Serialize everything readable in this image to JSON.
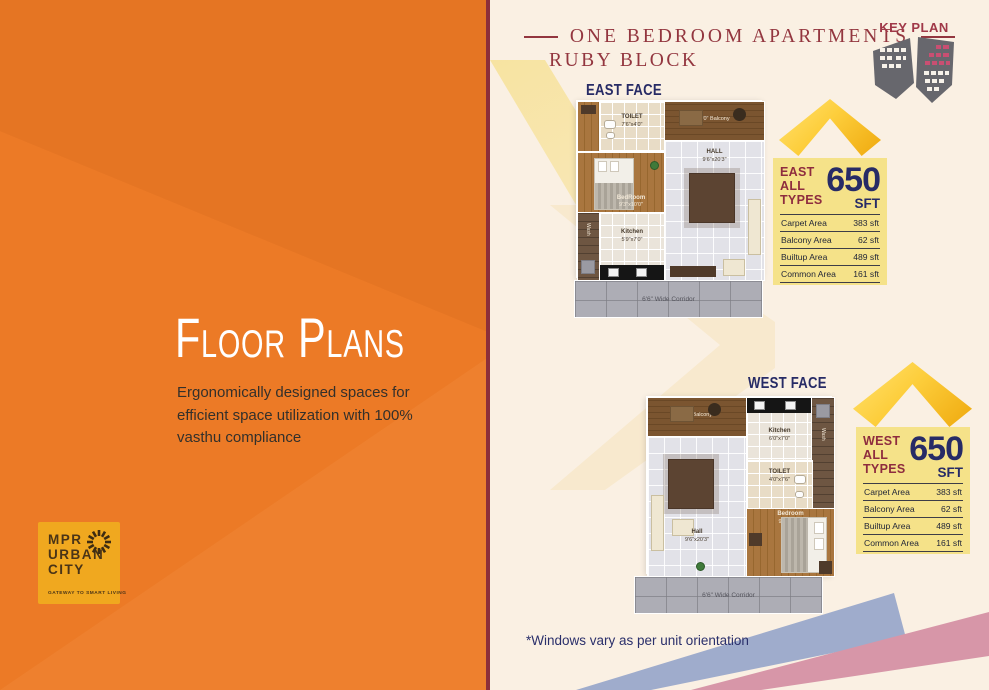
{
  "left_panel": {
    "title": "Floor Plans",
    "description": "Ergonomically designed spaces for efficient space utilization with 100% vasthu compliance",
    "logo": {
      "name_line1": "MPR",
      "name_line2": "URBAN",
      "name_line3": "CITY",
      "tagline": "GATEWAY TO SMART LIVING",
      "icon": "sunburst-icon"
    }
  },
  "right_panel": {
    "heading": {
      "title": "ONE BEDROOM APARTMENTS",
      "subtitle": "RUBY BLOCK"
    },
    "key_plan_label": "KEY PLAN",
    "east": {
      "face_label": "EAST FACE",
      "plan": {
        "balcony": "4'0\" Balcony",
        "toilet_name": "TOILET",
        "toilet_dim": "7'6\"x4'0\"",
        "bedroom_name": "BedRoom",
        "bedroom_dim": "9'3\"x10'0\"",
        "hall_name": "HALL",
        "hall_dim": "9'6\"x20'3\"",
        "kitchen_name": "Kitchen",
        "kitchen_dim": "5'9\"x7'0\"",
        "wash": "Wash",
        "corridor": "6'6\" Wide Corridor"
      },
      "table": {
        "block": "EAST",
        "line2": "ALL",
        "line3": "TYPES",
        "area_value": "650",
        "area_unit": "SFT",
        "rows": [
          {
            "label": "Carpet Area",
            "value": "383 sft"
          },
          {
            "label": "Balcony Area",
            "value": "62 sft"
          },
          {
            "label": "Builtup Area",
            "value": "489 sft"
          },
          {
            "label": "Common Area",
            "value": "161 sft"
          }
        ]
      }
    },
    "west": {
      "face_label": "WEST FACE",
      "plan": {
        "balcony": "4'0\" Balcony",
        "toilet_name": "TOILET",
        "toilet_dim": "4'0\"x7'6\"",
        "bedroom_name": "Bedroom",
        "bedroom_dim": "9'3\"x10'0\"",
        "hall_name": "Hall",
        "hall_dim": "9'6\"x20'3\"",
        "kitchen_name": "Kitchen",
        "kitchen_dim": "6'0\"x7'0\"",
        "wash": "Wash",
        "corridor": "6'6\" Wide Corridor"
      },
      "table": {
        "block": "WEST",
        "line2": "ALL",
        "line3": "TYPES",
        "area_value": "650",
        "area_unit": "SFT",
        "rows": [
          {
            "label": "Carpet Area",
            "value": "383 sft"
          },
          {
            "label": "Balcony Area",
            "value": "62 sft"
          },
          {
            "label": "Builtup Area",
            "value": "489 sft"
          },
          {
            "label": "Common Area",
            "value": "161 sft"
          }
        ]
      }
    },
    "footnote": "*Windows vary as per unit orientation"
  },
  "colors": {
    "orange": "#EC7A26",
    "maroon": "#93363F",
    "navy": "#272B66",
    "table_yellow": "#F5E289",
    "gold": "#FDCE3C",
    "cream": "#FAF0E3",
    "ribbon_blue": "#9FACCC",
    "ribbon_pink": "#D796A8"
  }
}
